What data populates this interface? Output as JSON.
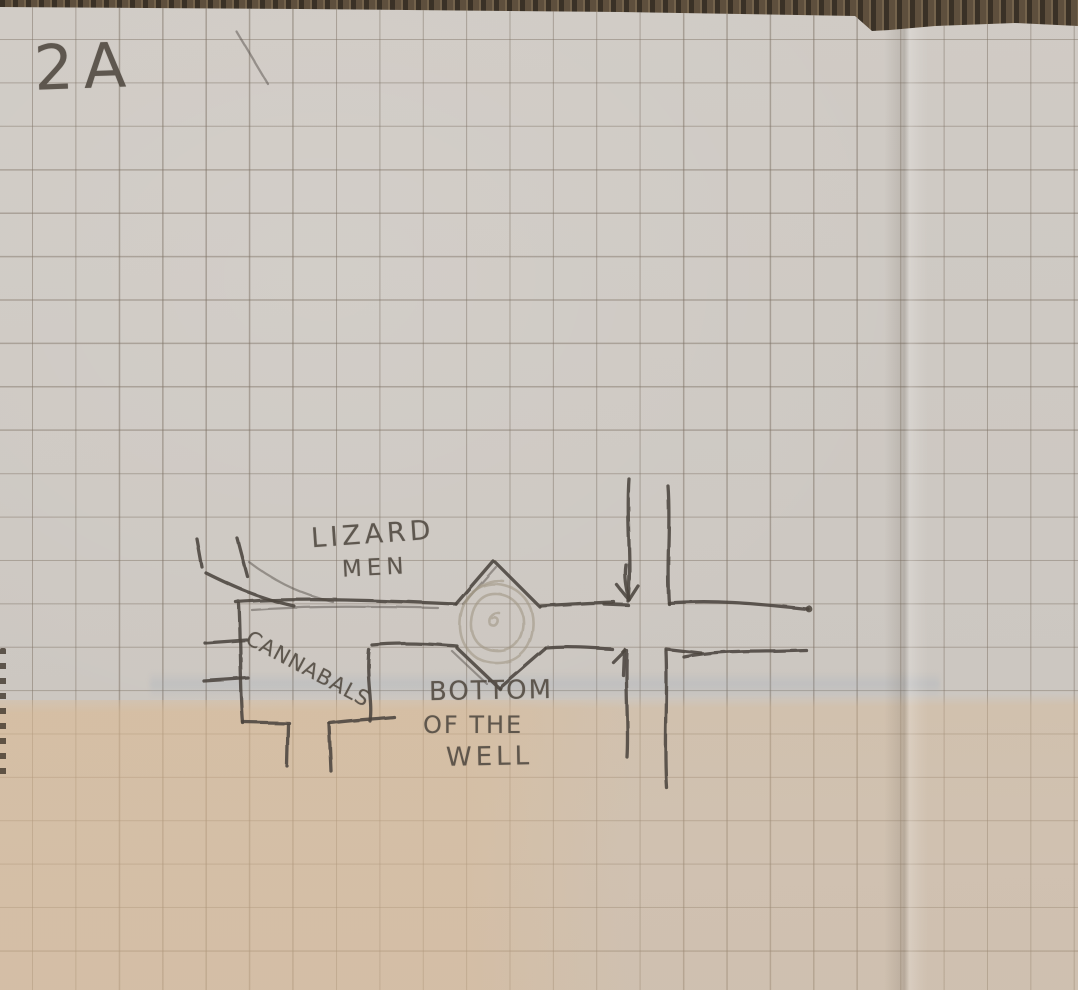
{
  "sheet": {
    "page_label": "2A",
    "annotations": {
      "lizard_men": {
        "line1": "LIZARD",
        "line2": "MEN"
      },
      "cannibals": {
        "line1": "CANNABALS"
      },
      "well": {
        "line1": "BOTTOM",
        "line2": "OF THE",
        "line3": "WELL"
      }
    },
    "features": [
      "graph-paper-grid",
      "main-corridor-east-west",
      "north-south-corridor",
      "well-room-diamond",
      "well-circle",
      "southwest-passage",
      "northwest-entrance",
      "direction-arrow",
      "fold-crease"
    ]
  },
  "colors": {
    "pencil": "#4c453d",
    "pencil-faint": "#a29786",
    "ink-text": "#554e45",
    "paper": "#cec9c3",
    "paper-tan": "#d8b892",
    "grid-line": "#978d82",
    "mat": "#5e4f3d",
    "mat-dark": "#3a3126"
  }
}
